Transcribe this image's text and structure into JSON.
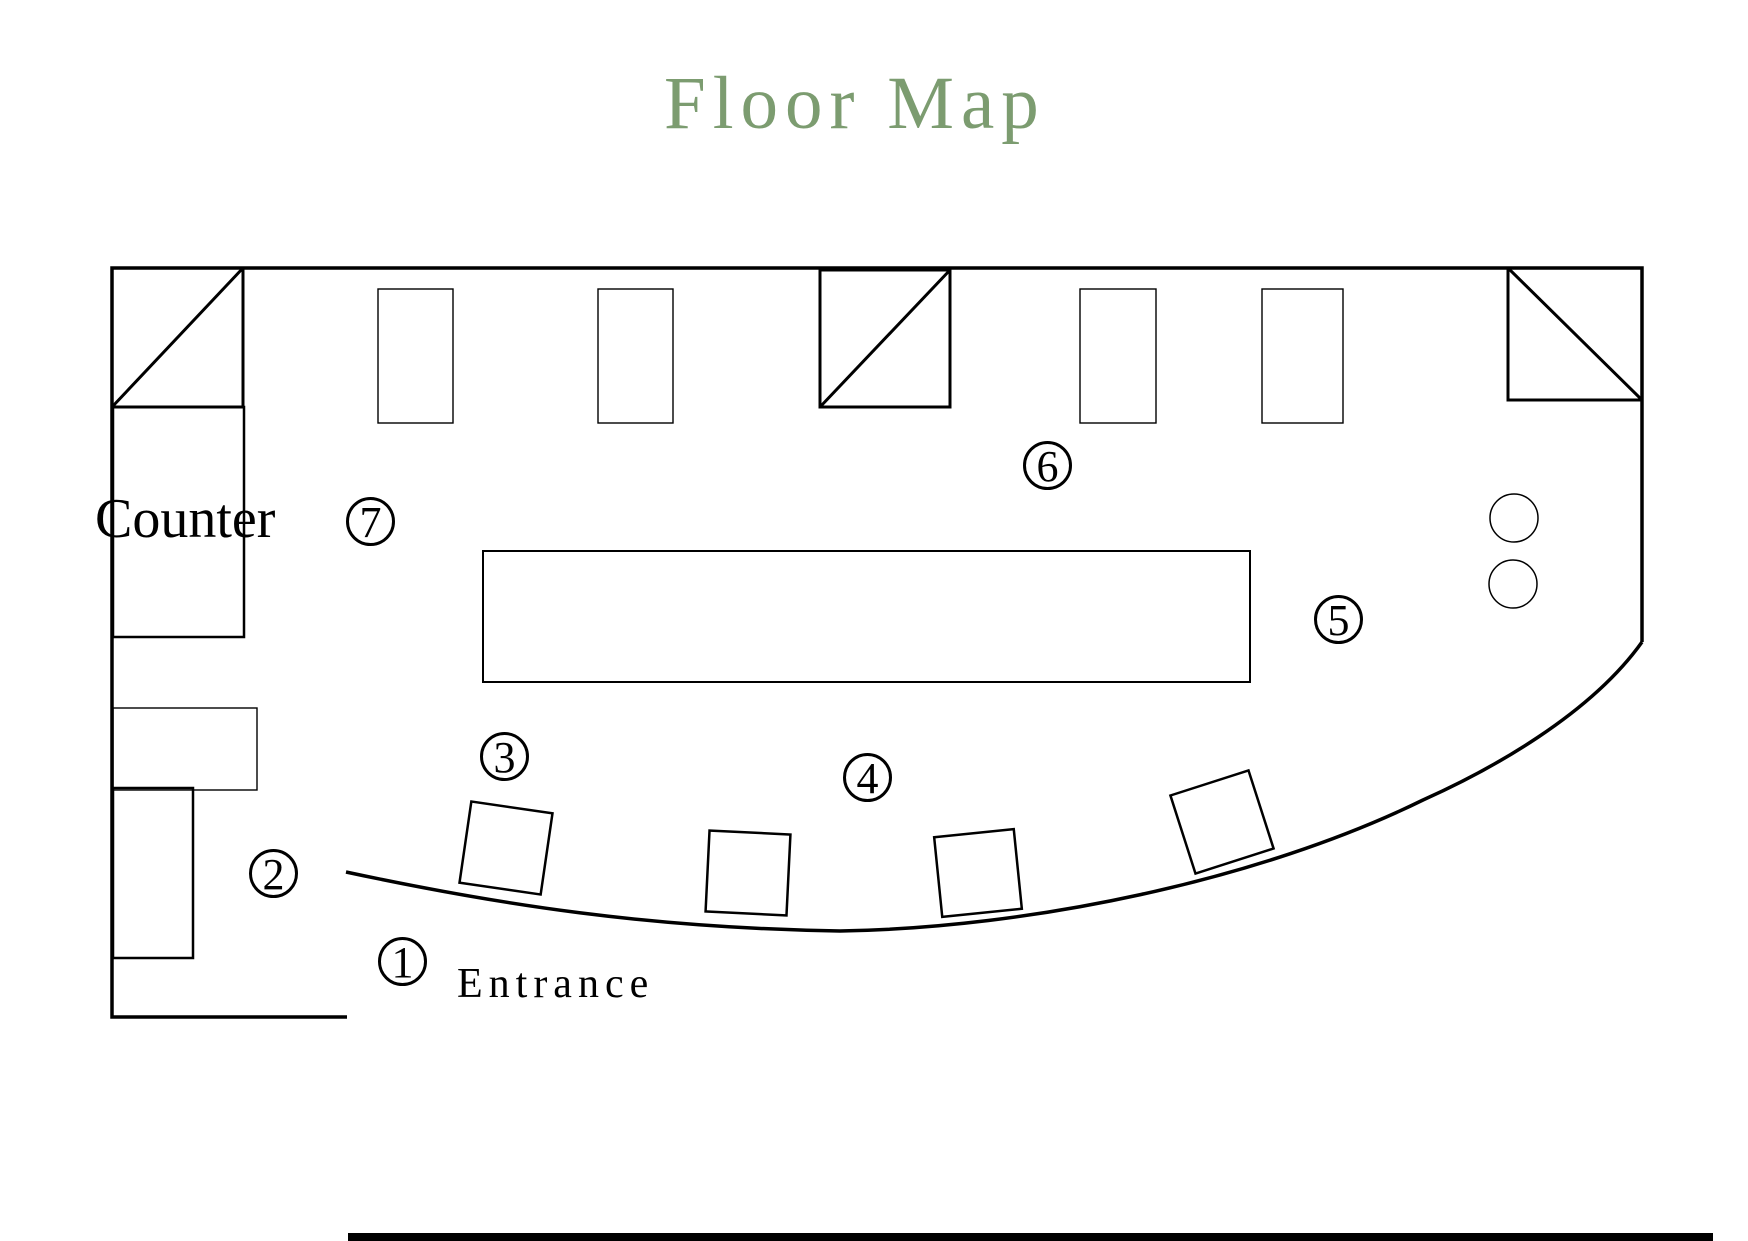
{
  "title": "Floor Map",
  "colors": {
    "title": "#7c9c70",
    "line": "#000000",
    "background": "#ffffff"
  },
  "labels": {
    "counter": "Counter",
    "entrance": "Entrance"
  },
  "markers": [
    {
      "number": "1"
    },
    {
      "number": "2"
    },
    {
      "number": "3"
    },
    {
      "number": "4"
    },
    {
      "number": "5"
    },
    {
      "number": "6"
    },
    {
      "number": "7"
    }
  ]
}
